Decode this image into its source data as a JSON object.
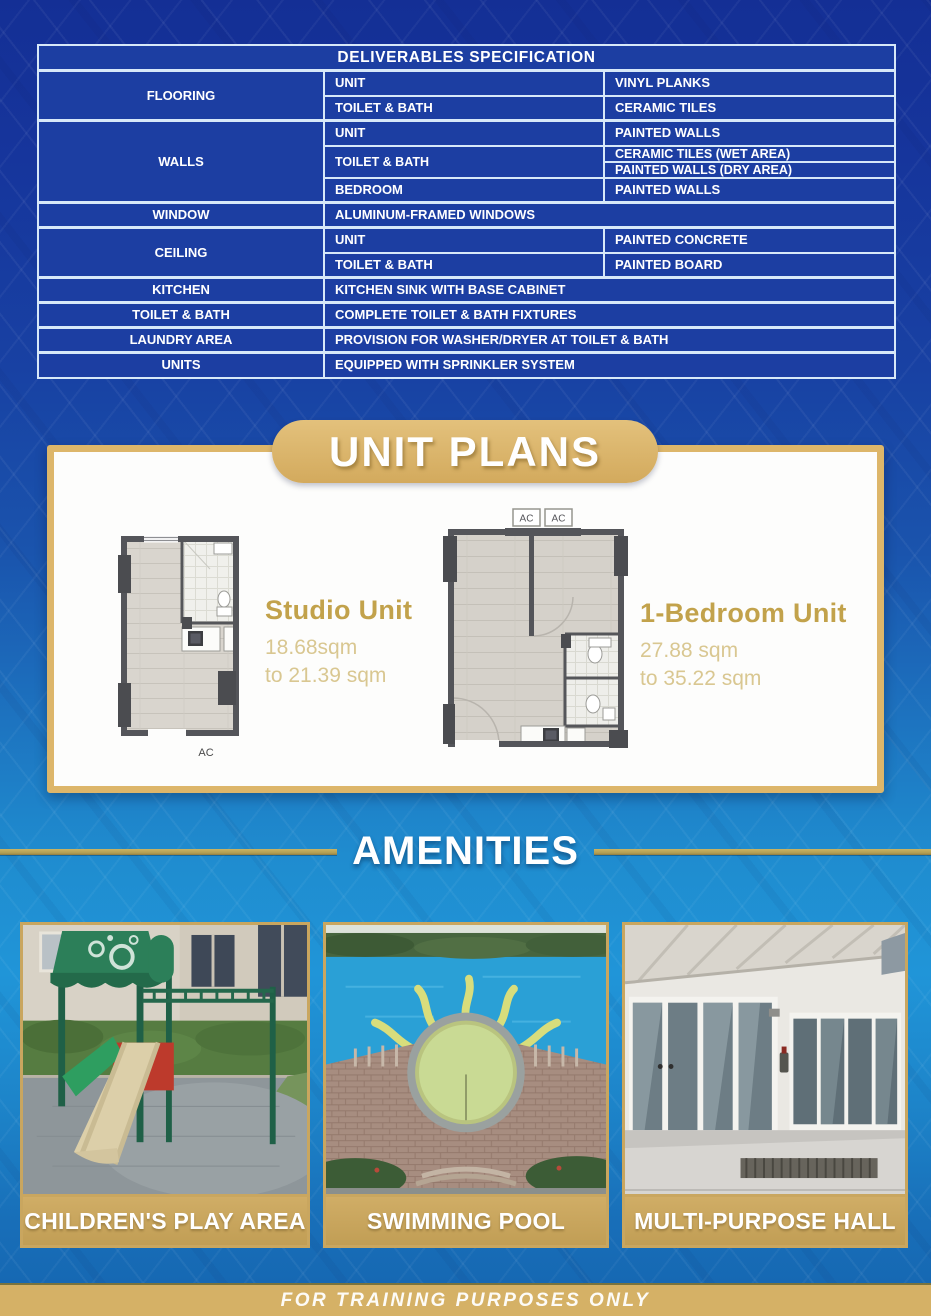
{
  "colors": {
    "brand_blue_dark": "#15339a",
    "brand_blue_light": "#2095d8",
    "table_cell_blue": "#1c3ea2",
    "table_border": "#d7e8f8",
    "gold_accent": "#d9b368",
    "plan_title_gold": "#c2a24b",
    "caption_bar_gold": "#c9a65f"
  },
  "spec": {
    "title": "DELIVERABLES SPECIFICATION",
    "flooring": {
      "label": "FLOORING",
      "unit_label": "UNIT",
      "unit_value": "VINYL PLANKS",
      "tb_label": "TOILET & BATH",
      "tb_value": "CERAMIC TILES"
    },
    "walls": {
      "label": "WALLS",
      "unit_label": "UNIT",
      "unit_value": "PAINTED WALLS",
      "tb_label": "TOILET & BATH",
      "tb_value_wet": "CERAMIC TILES (WET AREA)",
      "tb_value_dry": "PAINTED WALLS (DRY AREA)",
      "bedroom_label": "BEDROOM",
      "bedroom_value": "PAINTED WALLS"
    },
    "window": {
      "label": "WINDOW",
      "value": "ALUMINUM-FRAMED WINDOWS"
    },
    "ceiling": {
      "label": "CEILING",
      "unit_label": "UNIT",
      "unit_value": "PAINTED CONCRETE",
      "tb_label": "TOILET & BATH",
      "tb_value": "PAINTED BOARD"
    },
    "kitchen": {
      "label": "KITCHEN",
      "value": "KITCHEN SINK WITH BASE CABINET"
    },
    "toilet_bath": {
      "label": "TOILET & BATH",
      "value": "COMPLETE TOILET & BATH FIXTURES"
    },
    "laundry": {
      "label": "LAUNDRY AREA",
      "value": "PROVISION FOR WASHER/DRYER AT TOILET & BATH"
    },
    "units": {
      "label": "UNITS",
      "value": "EQUIPPED WITH SPRINKLER SYSTEM"
    }
  },
  "unit_plans": {
    "title": "UNIT PLANS",
    "studio": {
      "name": "Studio Unit",
      "area_from": "18.68sqm",
      "area_to": "to 21.39 sqm",
      "ac_label": "AC"
    },
    "one_bedroom": {
      "name": "1-Bedroom Unit",
      "area_from": "27.88 sqm",
      "area_to": "to 35.22 sqm",
      "ac_label_left": "AC",
      "ac_label_right": "AC"
    }
  },
  "amenities": {
    "title": "AMENITIES",
    "items": [
      {
        "caption": "CHILDREN'S PLAY AREA"
      },
      {
        "caption": "SWIMMING POOL"
      },
      {
        "caption": "MULTI-PURPOSE HALL"
      }
    ]
  },
  "footer": {
    "text": "FOR TRAINING PURPOSES ONLY"
  }
}
